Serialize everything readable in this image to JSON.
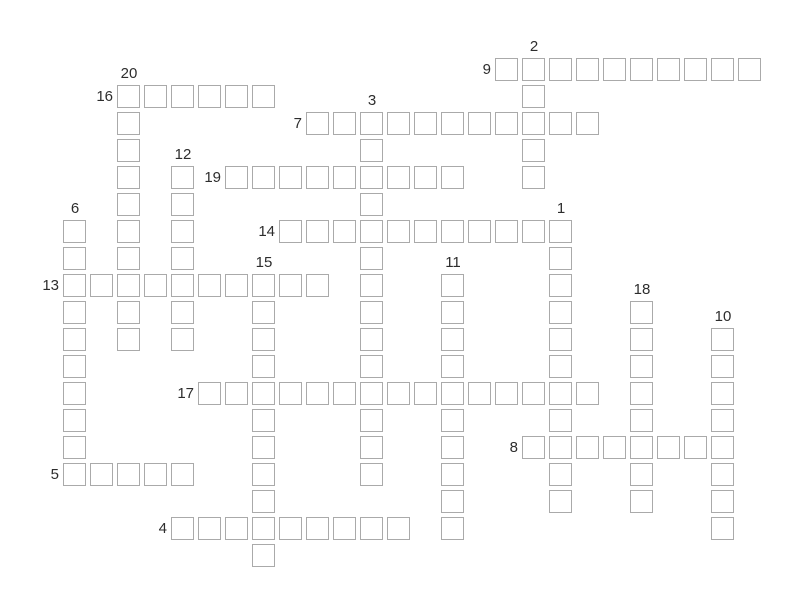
{
  "page": {
    "title": "Crossword puzzle grid",
    "background_color": "#ffffff",
    "state": "empty cells, numbered clues 1-20"
  },
  "grid": {
    "origin_x": 63,
    "origin_y": 58,
    "pitch": 27,
    "cell_size": 23,
    "columns": 26,
    "rows": 19,
    "border_color": "#aaaaaa",
    "cell_fill": "#ffffff",
    "label_color": "#2d2d2d",
    "label_font_size": 15
  },
  "entries": [
    {
      "number": 1,
      "direction": "down",
      "col": 18,
      "row": 6,
      "length": 11
    },
    {
      "number": 2,
      "direction": "down",
      "col": 17,
      "row": 0,
      "length": 5
    },
    {
      "number": 3,
      "direction": "down",
      "col": 11,
      "row": 2,
      "length": 14
    },
    {
      "number": 4,
      "direction": "across",
      "col": 4,
      "row": 17,
      "length": 9
    },
    {
      "number": 5,
      "direction": "across",
      "col": 0,
      "row": 15,
      "length": 5
    },
    {
      "number": 6,
      "direction": "down",
      "col": 0,
      "row": 6,
      "length": 10
    },
    {
      "number": 7,
      "direction": "across",
      "col": 9,
      "row": 2,
      "length": 11
    },
    {
      "number": 8,
      "direction": "across",
      "col": 17,
      "row": 14,
      "length": 8
    },
    {
      "number": 9,
      "direction": "across",
      "col": 16,
      "row": 0,
      "length": 10
    },
    {
      "number": 10,
      "direction": "down",
      "col": 24,
      "row": 10,
      "length": 8
    },
    {
      "number": 11,
      "direction": "down",
      "col": 14,
      "row": 8,
      "length": 10
    },
    {
      "number": 12,
      "direction": "down",
      "col": 4,
      "row": 4,
      "length": 7
    },
    {
      "number": 13,
      "direction": "across",
      "col": 0,
      "row": 8,
      "length": 10
    },
    {
      "number": 14,
      "direction": "across",
      "col": 8,
      "row": 6,
      "length": 11
    },
    {
      "number": 15,
      "direction": "down",
      "col": 7,
      "row": 8,
      "length": 11
    },
    {
      "number": 16,
      "direction": "across",
      "col": 2,
      "row": 1,
      "length": 6
    },
    {
      "number": 17,
      "direction": "across",
      "col": 5,
      "row": 12,
      "length": 15
    },
    {
      "number": 18,
      "direction": "down",
      "col": 21,
      "row": 9,
      "length": 8
    },
    {
      "number": 19,
      "direction": "across",
      "col": 6,
      "row": 4,
      "length": 9
    },
    {
      "number": 20,
      "direction": "down",
      "col": 2,
      "row": 1,
      "length": 10
    }
  ]
}
